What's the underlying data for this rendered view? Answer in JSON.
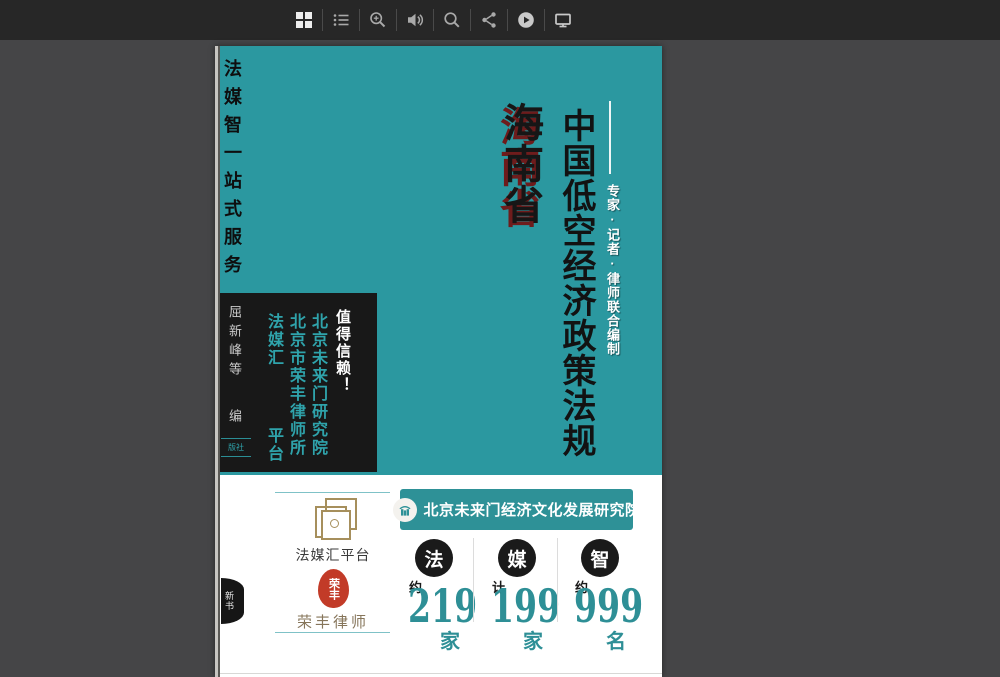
{
  "toolbar": {
    "icons": [
      {
        "name": "thumbnails-grid-icon"
      },
      {
        "name": "table-of-contents-icon"
      },
      {
        "name": "zoom-in-icon"
      },
      {
        "name": "audio-icon"
      },
      {
        "name": "search-icon"
      },
      {
        "name": "share-icon"
      },
      {
        "name": "autoplay-icon"
      },
      {
        "name": "fullscreen-monitor-icon"
      }
    ]
  },
  "cover": {
    "spine_title": "法媒智一站式服务",
    "region": "海南省",
    "main_title": "中国低空经济政策法规",
    "subtitle": "专家·记者·律师联合编制",
    "trust_slogan": "值得信赖！",
    "org_column_1": "北京未来门研究院",
    "org_column_2": "北京市荣丰律师所",
    "org_column_3_top": "法媒汇",
    "org_column_3_bottom": "平台",
    "editors": "屈新峰等",
    "editor_role": "编",
    "publisher_partial": "版社",
    "badge": "新书"
  },
  "footer": {
    "logo1_label": "法媒汇平台",
    "seal_text": "荣丰",
    "logo2_label": "荣丰律师",
    "banner_text": "北京未来门经济文化发展研究院",
    "stats": [
      {
        "circle": "法",
        "qualifier": "约",
        "value": "219",
        "unit": "家"
      },
      {
        "circle": "媒",
        "qualifier": "计",
        "value": "199",
        "unit": "家"
      },
      {
        "circle": "智",
        "qualifier": "约",
        "value": "999",
        "unit": "名"
      }
    ]
  },
  "colors": {
    "cover_teal": "#2B98A0",
    "banner_teal": "#2E9197",
    "stat_number_teal": "#2E8F96",
    "region_shadow_red": "#6E1C1C",
    "seal_red": "#C23B28",
    "gold_logo": "#A68F5C",
    "black_box": "#181818",
    "toolbar_bg": "#272727",
    "viewer_bg": "#454547"
  }
}
